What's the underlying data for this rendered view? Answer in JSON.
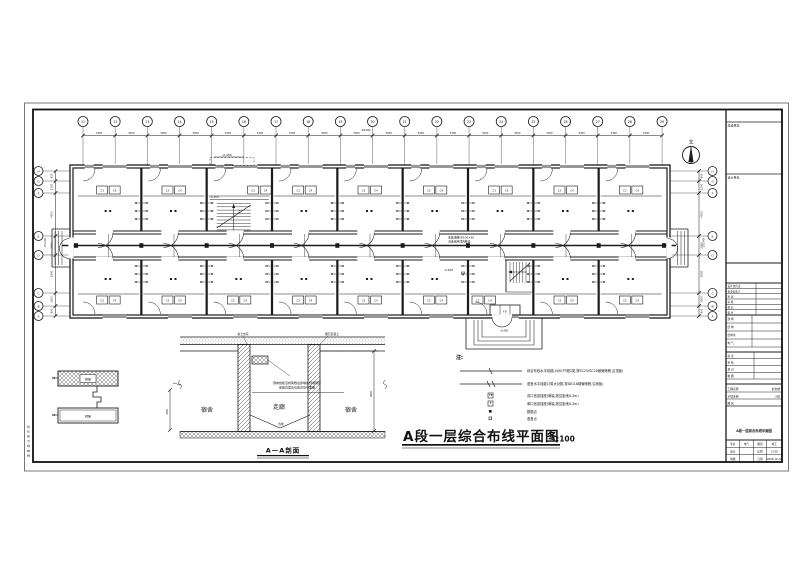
{
  "drawing_title": {
    "text": "A段一层综合布线平面图",
    "scale": "1:100"
  },
  "north_label": "北",
  "margin_text": "建筑设计研究院",
  "plan": {
    "grid_top": {
      "labels": [
        "11",
        "12",
        "13",
        "14",
        "15",
        "16",
        "17",
        "18",
        "19",
        "20",
        "21",
        "22",
        "23",
        "24",
        "25",
        "26",
        "27",
        "28",
        "29"
      ],
      "bay_dim": "3300",
      "total_dim": "59440"
    },
    "grid_side": {
      "labels_top_to_bottom": [
        "H",
        "G",
        "F",
        "E",
        "D",
        "C",
        "B",
        "A"
      ],
      "segment_dims": [
        "900",
        "1200",
        "4500",
        "2000",
        "3900",
        "1300",
        "900"
      ],
      "total_dim": "15140"
    },
    "elevations": {
      "canopy": "-0.450",
      "stair_top": "-0.450",
      "stair_lobby": "-0.450",
      "entry": "-0.450"
    },
    "closet_labels": [
      "C3",
      "C4"
    ],
    "stair_up_label": "上",
    "fd_label": "FD",
    "corridor_note_line1": "金属线槽SR100×50",
    "corridor_note_line2": "沿走廊吊顶内敷设"
  },
  "legend": {
    "title": "注:",
    "items": [
      {
        "symbol": "cable-data",
        "text": "综合布线水平线缆(4对UTP超5类,穿SC25/SC20钢管暗敷,沿顶板)"
      },
      {
        "symbol": "cable-voice",
        "text": "语音水平线缆(3类大对数,穿JDG16钢管暗敷,沿地板)"
      },
      {
        "symbol": "outlet-double",
        "text": "双口信息插座(暗装,底边距地0.3m)"
      },
      {
        "symbol": "outlet-single",
        "text": "单口信息插座(暗装,底边距地0.3m)"
      },
      {
        "symbol": "dot-data",
        "text": "数据点"
      },
      {
        "symbol": "dot-voice",
        "text": "语音点"
      }
    ]
  },
  "section": {
    "title": "A—A剖面",
    "room_left": "宿舍",
    "corridor": "走廊",
    "room_right": "宿舍",
    "note_top_left": "素土夯实",
    "note_top_right": "细石混凝土",
    "note_center_line1": "弱电线缆沿桥架敷设穿墙处预埋钢管",
    "note_center_line2": "安装高度及位置详见平面图",
    "dim_right": "900",
    "slope_label": "找坡"
  },
  "tray_detail": {
    "label_top": "桥架",
    "label_bottom": "桥架",
    "dim": "300"
  },
  "titleblock": {
    "cell_top1_label": "建设单位",
    "cell_top2_label": "设计单位",
    "sign_rows": [
      "设计总负责",
      "专业负责人",
      "审  定",
      "审  核",
      "校  对",
      "设  计"
    ],
    "approval_rows": [
      "建  筑",
      "结  构",
      "给排水",
      "电  气"
    ],
    "check_rows": [
      "审  定",
      "审  核",
      "校  对",
      "制  图"
    ],
    "project_label": "工程名称",
    "project_value": "宿舍楼",
    "subitem_label": "子项名称",
    "subitem_value": "A段",
    "figname_label": "图  名",
    "figname_value": "A段一层综合布线平面图",
    "mini_table": [
      [
        "专业",
        "电气",
        "图别",
        "施工"
      ],
      [
        "设计",
        "",
        "比例",
        "1:100"
      ],
      [
        "制图",
        "",
        "日期",
        "2006.12.22"
      ]
    ]
  }
}
